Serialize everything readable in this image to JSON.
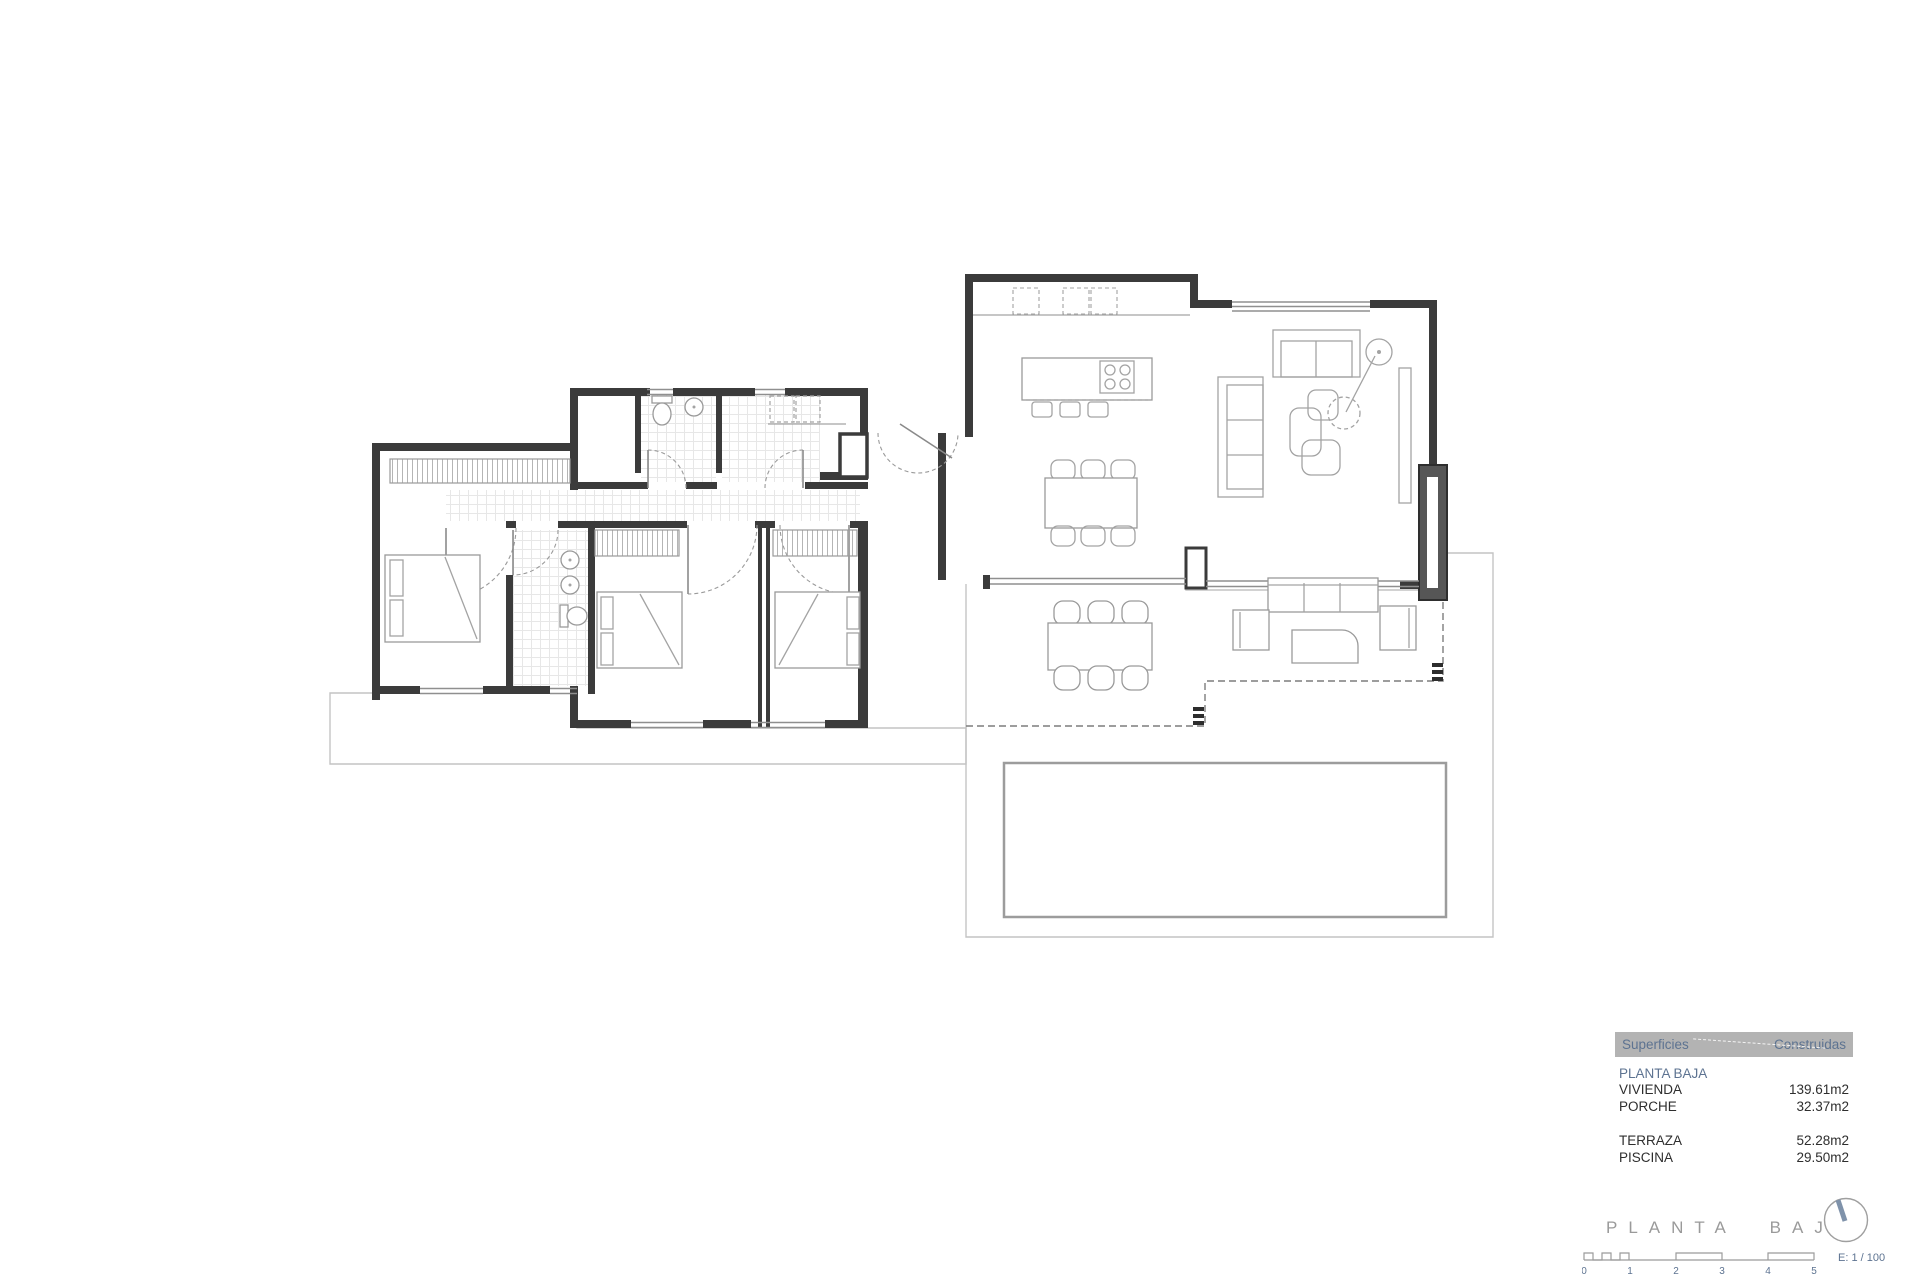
{
  "document": {
    "type": "architectural-floor-plan",
    "floor": "ground-floor"
  },
  "colors": {
    "wall": "#3b3b3b",
    "furniture_line": "#a3a3a3",
    "tile_line": "#e2e2e2",
    "legend_header_bg": "#b3b3b3",
    "accent_blue": "#5d7391",
    "title_gray": "#9a9a9a",
    "logo_stroke": "#7f92aa"
  },
  "legend": {
    "header": {
      "col1": "Superficies",
      "col2": "Construidas"
    },
    "section": "PLANTA BAJA",
    "rows": [
      {
        "label": "VIVIENDA",
        "value": "139.61m2"
      },
      {
        "label": "PORCHE",
        "value": "32.37m2"
      },
      {
        "label": "TERRAZA",
        "value": "52.28m2"
      },
      {
        "label": "PISCINA",
        "value": "29.50m2"
      }
    ]
  },
  "title_block": {
    "title": "PLANTA BAJA",
    "scale_label": "E: 1 / 100",
    "scale_ticks": [
      "0",
      "1",
      "2",
      "3",
      "4",
      "5"
    ]
  }
}
